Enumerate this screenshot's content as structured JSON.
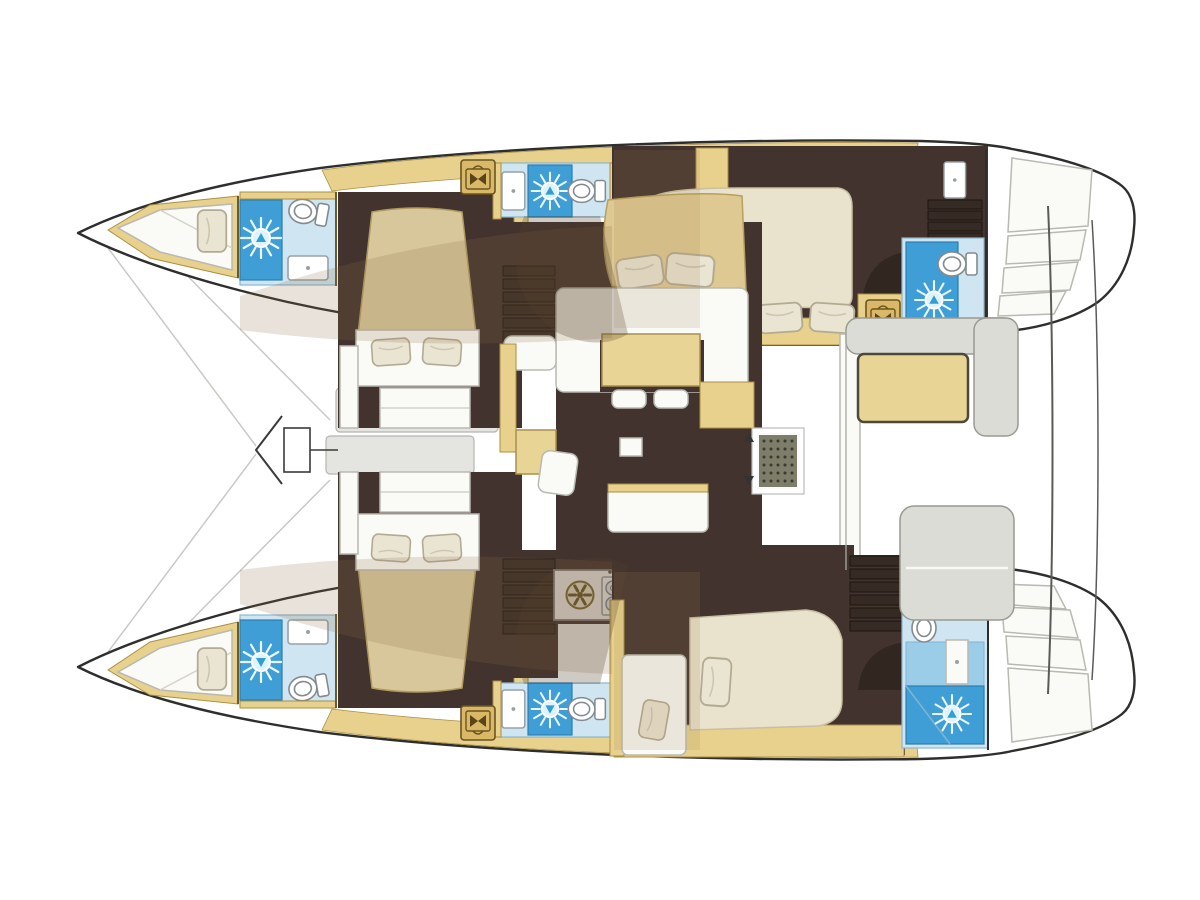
{
  "image": {
    "kind": "boat floor plan illustration",
    "subject": "sailing catamaran accommodation and deck layout, top view",
    "orientation": "bows at left, twin transom steps at right, mirrored port and starboard hulls"
  },
  "colors": {
    "outline": "#2e2e2c",
    "hull": "#ffffff",
    "deck-tan": "#e8d18c",
    "floor-dark": "#42332e",
    "floor-darker": "#362a24",
    "bed-ivory": "#e9e2cc",
    "bed-tan": "#d9c79c",
    "pillow": "#eae4d3",
    "head-blue": "#cfe6f2",
    "shower-blue": "#3f9ed6",
    "shower-mid": "#9ccde8",
    "furn-white": "#fafaf7",
    "seat-gray": "#dcdcd6",
    "panel-gray": "#e4e4e0",
    "hatch-gold": "#d9b968",
    "grate": "#7d7d6a",
    "galley-sink": "#61707a",
    "table-wood": "#e8d494",
    "sofa-tan": "#dfc993",
    "shade": "rgba(140,110,68,0.22)"
  },
  "vessel": {
    "hulls": [
      {
        "side": "port (top hull)",
        "rooms": [
          "forepeak berth",
          "bow head with shower",
          "forward island-bed cabin",
          "mid head with shower and toilet",
          "companionway stairs",
          "aft double cabin",
          "aft head with shower and toilet"
        ]
      },
      {
        "side": "starboard (bottom hull)",
        "rooms": [
          "forepeak berth",
          "bow head with shower",
          "forward island-bed cabin",
          "mid head with shower and toilet",
          "companionway stairs",
          "aft cabin with double bed and single berth",
          "aft head with shower and toilet"
        ]
      }
    ],
    "bridgedeck": {
      "rooms": [
        "saloon with curved sofa, dinette table and stools",
        "nav station with chart seat",
        "galley with 4-burner stove, sink and two round burners",
        "kitchen island",
        "engine/vent grate at companionway door",
        "storage hatch lockers"
      ],
      "exterior": [
        "foredeck panels and mast fitting",
        "trampoline lines",
        "cockpit with table and bench seats",
        "aft bench seat",
        "twin transom steps",
        "aft platform rails"
      ]
    },
    "fixture_counts": {
      "toilets": 6,
      "shower_suns": 6,
      "basins": 6,
      "galley_sink": 1,
      "stove_burners": 4,
      "round_burners": 2,
      "gold_deck_hatches": 5,
      "stair_flights": 4
    }
  }
}
